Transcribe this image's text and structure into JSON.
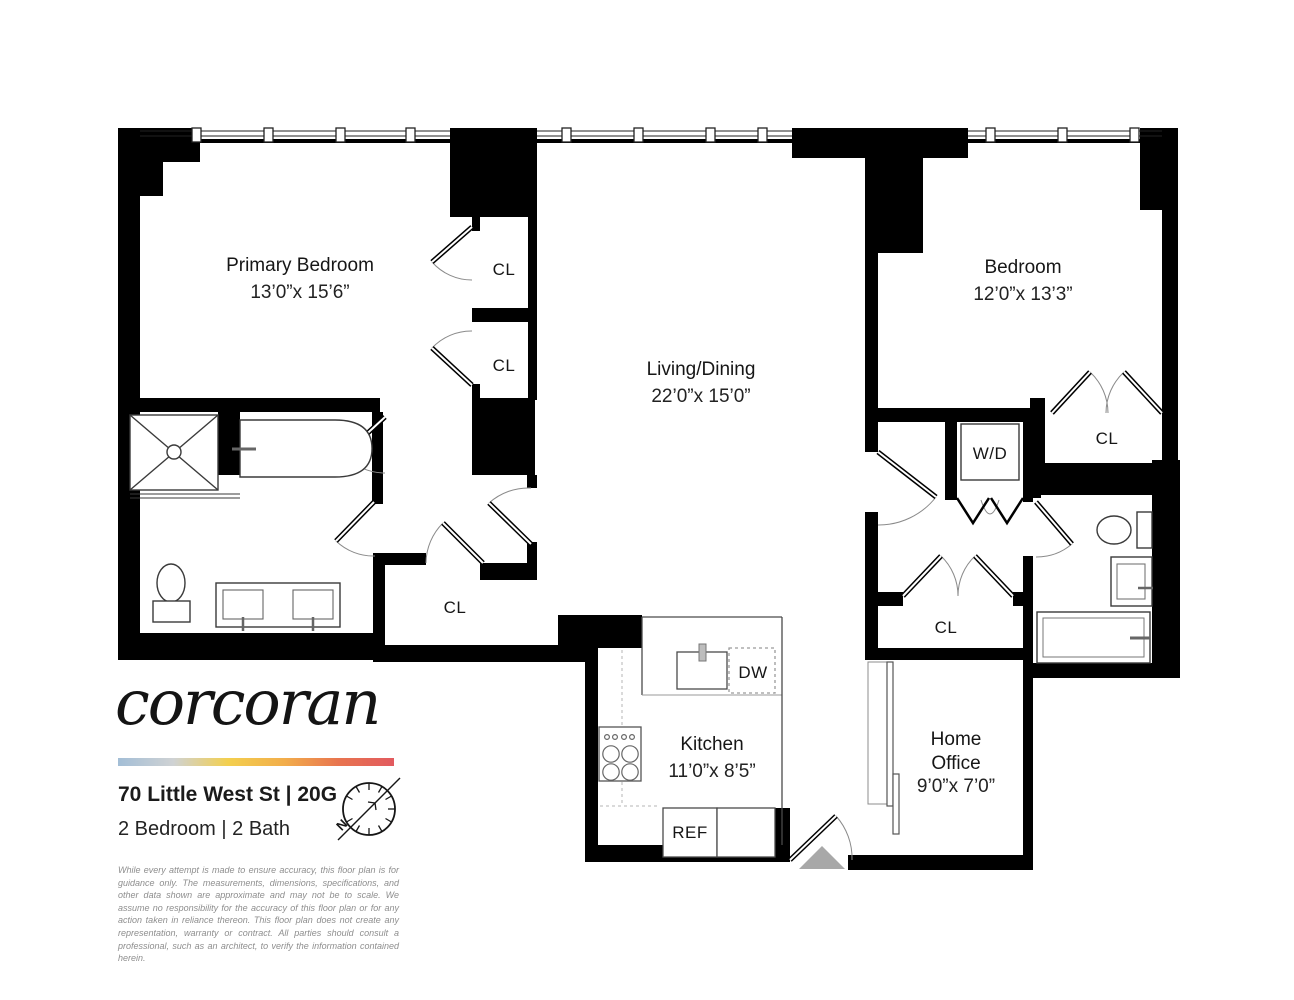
{
  "branding": {
    "logo_text": "corcoran",
    "address": "70 Little West St | 20G",
    "unit_info": "2 Bedroom | 2 Bath",
    "compass_north": "N",
    "gradient_colors": [
      "#a3bed6",
      "#cfd2d4",
      "#f3cf4e",
      "#f2ae4b",
      "#e8744f",
      "#e25a5f"
    ],
    "disclaimer": "While every attempt is made to ensure accuracy, this floor plan is for guidance only. The measurements, dimensions, specifications, and other data shown are approximate and may not be to scale. We assume no responsibility for the accuracy of this floor plan or for any action taken in reliance thereon. This floor plan does not create any representation, warranty or contract. All parties should consult a professional, such as an architect, to verify the information contained herein."
  },
  "rooms": {
    "primary_bedroom": {
      "name": "Primary Bedroom",
      "dims": "13’0”x 15’6”"
    },
    "living_dining": {
      "name": "Living/Dining",
      "dims": "22’0”x 15’0”"
    },
    "bedroom": {
      "name": "Bedroom",
      "dims": "12’0”x 13’3”"
    },
    "kitchen": {
      "name": "Kitchen",
      "dims": "11’0”x 8’5”"
    },
    "home_office": {
      "line1": "Home",
      "line2": "Office",
      "dims": "9’0”x 7’0”"
    }
  },
  "fixtures": {
    "closet": "CL",
    "washer_dryer": "W/D",
    "dishwasher": "DW",
    "refrigerator": "REF"
  }
}
